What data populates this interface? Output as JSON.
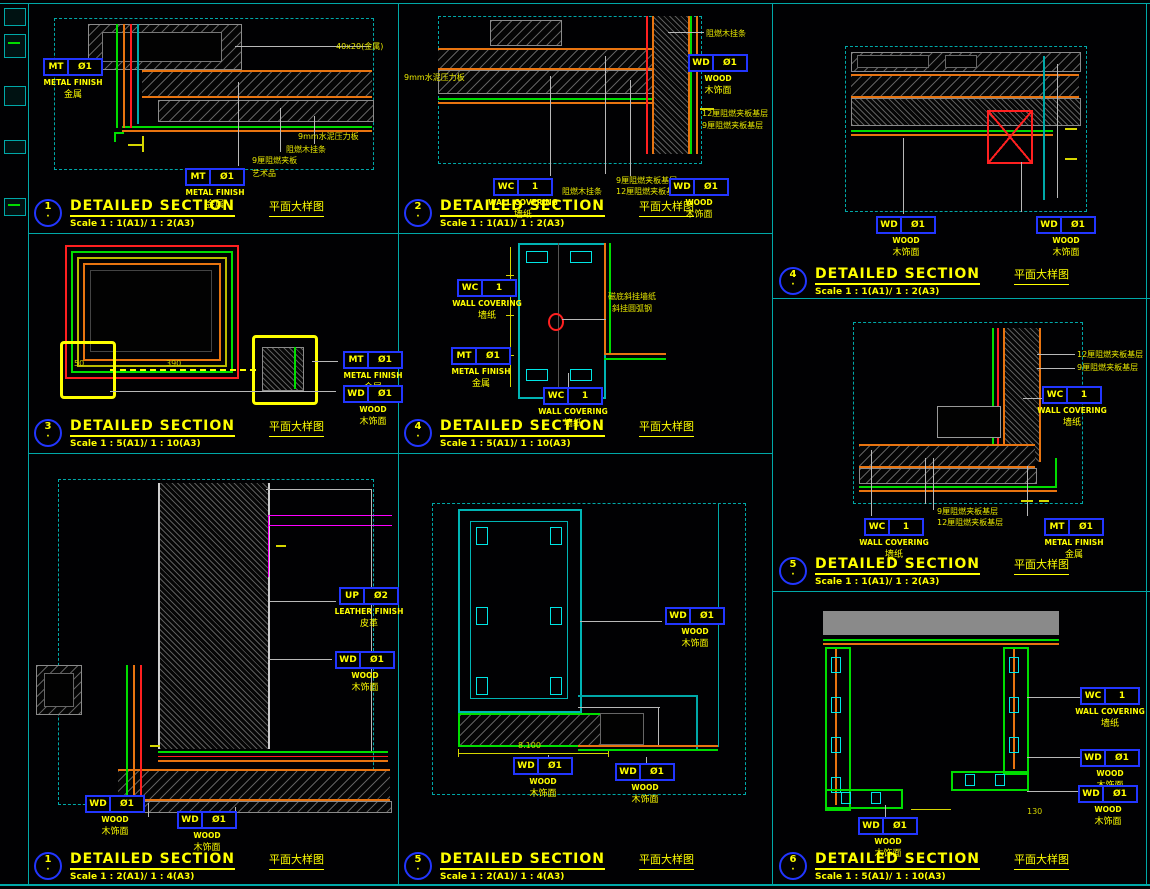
{
  "sheet": {
    "title_label": "DETAILED SECTION",
    "subtitle_cn": "平面大样图",
    "colors": {
      "background": "#010103",
      "line_cyan": "#00a8a8",
      "line_orange": "#e87410",
      "line_green": "#00dd00",
      "line_red": "#ff2020",
      "line_magenta": "#ff00ff",
      "text_yellow": "#ffff00",
      "tag_blue": "#2236ff"
    }
  },
  "panels": [
    {
      "number": "1",
      "scale": "Scale 1 : 1(A1)/ 1 : 2(A3)",
      "tags": [
        {
          "code": "MT",
          "num": "Ø1",
          "en": "METAL FINISH",
          "cn": "金属"
        },
        {
          "code": "MT",
          "num": "Ø1",
          "en": "METAL FINISH",
          "cn": "金属"
        }
      ],
      "leaders": [
        "40x20(金属)",
        "9mm水泥压力板",
        "阻燃木挂条",
        "9厘阻燃夹板",
        "艺术品"
      ],
      "dims": []
    },
    {
      "number": "2",
      "scale": "Scale 1 : 1(A1)/ 1 : 2(A3)",
      "tags": [
        {
          "code": "WD",
          "num": "Ø1",
          "en": "WOOD",
          "cn": "木饰面"
        },
        {
          "code": "WC",
          "num": "1",
          "en": "WALL COVERING",
          "cn": "墙纸"
        },
        {
          "code": "WD",
          "num": "Ø1",
          "en": "WOOD",
          "cn": "木饰面"
        }
      ],
      "leaders": [
        "9mm水泥压力板",
        "阻燃木挂条",
        "12厘阻燃夹板基层",
        "9厘阻燃夹板基层",
        "阻燃木挂条",
        "9厘阻燃夹板基层",
        "12厘阻燃夹板基层"
      ],
      "dims": []
    },
    {
      "number": "4",
      "scale": "Scale 1 : 1(A1)/ 1 : 2(A3)",
      "tags": [
        {
          "code": "WD",
          "num": "Ø1",
          "en": "WOOD",
          "cn": "木饰面"
        },
        {
          "code": "WD",
          "num": "Ø1",
          "en": "WOOD",
          "cn": "木饰面"
        }
      ],
      "leaders": [],
      "dims": []
    },
    {
      "number": "3",
      "scale": "Scale 1 : 5(A1)/ 1 : 10(A3)",
      "tags": [
        {
          "code": "MT",
          "num": "Ø1",
          "en": "METAL FINISH",
          "cn": "金属"
        },
        {
          "code": "WD",
          "num": "Ø1",
          "en": "WOOD",
          "cn": "木饰面"
        }
      ],
      "leaders": [],
      "dims": [
        "50",
        "390"
      ]
    },
    {
      "number": "4",
      "scale": "Scale 1 : 5(A1)/ 1 : 10(A3)",
      "tags": [
        {
          "code": "WC",
          "num": "1",
          "en": "WALL COVERING",
          "cn": "墙纸"
        },
        {
          "code": "MT",
          "num": "Ø1",
          "en": "METAL FINISH",
          "cn": "金属"
        },
        {
          "code": "WC",
          "num": "1",
          "en": "WALL COVERING",
          "cn": "墙纸"
        }
      ],
      "leaders": [
        "磁底斜挂墙纸",
        "斜挂圆弧钢"
      ],
      "dims": []
    },
    {
      "number": "5",
      "scale": "Scale 1 : 1(A1)/ 1 : 2(A3)",
      "tags": [
        {
          "code": "WC",
          "num": "1",
          "en": "WALL COVERING",
          "cn": "墙纸"
        },
        {
          "code": "WC",
          "num": "1",
          "en": "WALL COVERING",
          "cn": "墙纸"
        },
        {
          "code": "MT",
          "num": "Ø1",
          "en": "METAL FINISH",
          "cn": "金属"
        }
      ],
      "leaders": [
        "12厘阻燃夹板基层",
        "9厘阻燃夹板基层",
        "9厘阻燃夹板基层",
        "12厘阻燃夹板基层"
      ],
      "dims": []
    },
    {
      "number": "1",
      "scale": "Scale 1 : 2(A1)/ 1 : 4(A3)",
      "tags": [
        {
          "code": "UP",
          "num": "Ø2",
          "en": "LEATHER FINISH",
          "cn": "皮革"
        },
        {
          "code": "WD",
          "num": "Ø1",
          "en": "WOOD",
          "cn": "木饰面"
        },
        {
          "code": "WD",
          "num": "Ø1",
          "en": "WOOD",
          "cn": "木饰面"
        },
        {
          "code": "WD",
          "num": "Ø1",
          "en": "WOOD",
          "cn": "木饰面"
        }
      ],
      "leaders": [],
      "dims": []
    },
    {
      "number": "5",
      "scale": "Scale 1 : 2(A1)/ 1 : 4(A3)",
      "tags": [
        {
          "code": "WD",
          "num": "Ø1",
          "en": "WOOD",
          "cn": "木饰面"
        },
        {
          "code": "WD",
          "num": "Ø1",
          "en": "WOOD",
          "cn": "木饰面"
        },
        {
          "code": "WD",
          "num": "Ø1",
          "en": "WOOD",
          "cn": "木饰面"
        }
      ],
      "leaders": [],
      "dims": [
        "8.100"
      ]
    },
    {
      "number": "6",
      "scale": "Scale 1 : 5(A1)/ 1 : 10(A3)",
      "tags": [
        {
          "code": "WC",
          "num": "1",
          "en": "WALL COVERING",
          "cn": "墙纸"
        },
        {
          "code": "WD",
          "num": "Ø1",
          "en": "WOOD",
          "cn": "木饰面"
        },
        {
          "code": "WD",
          "num": "Ø1",
          "en": "WOOD",
          "cn": "木饰面"
        },
        {
          "code": "WD",
          "num": "Ø1",
          "en": "WOOD",
          "cn": "木饰面"
        }
      ],
      "leaders": [],
      "dims": [
        "130"
      ]
    }
  ]
}
